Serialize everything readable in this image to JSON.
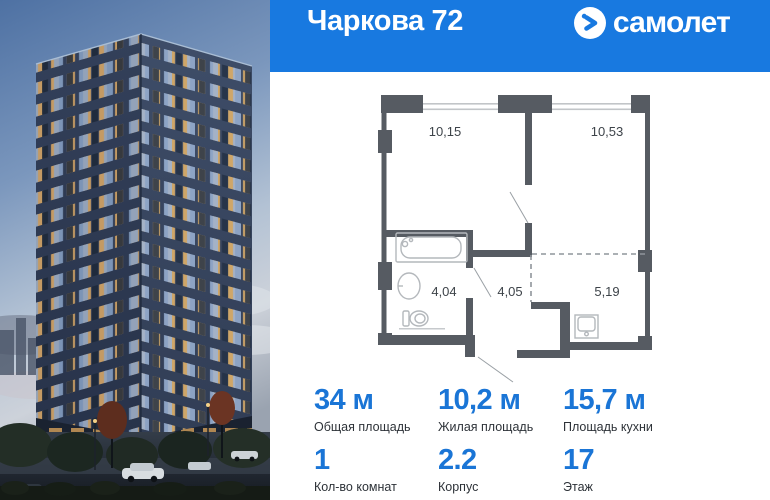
{
  "colors": {
    "header_bg": "#1879e0",
    "accent": "#1a75d6",
    "plan_wall": "#565b62"
  },
  "header": {
    "title": "Чаркова 72",
    "brand": "самолет",
    "brand_icon": "samolet-arrow-circle"
  },
  "plan": {
    "rooms": {
      "living1": "10,15",
      "living2": "10,53",
      "bathroom": "4,04",
      "hallway": "4,05",
      "kitchen": "5,19"
    }
  },
  "stats": {
    "total_area": {
      "value": "34 м",
      "label": "Общая площадь"
    },
    "living_area": {
      "value": "10,2 м",
      "label": "Жилая площадь"
    },
    "kitchen_area": {
      "value": "15,7 м",
      "label": "Площадь кухни"
    },
    "room_count": {
      "value": "1",
      "label": "Кол-во комнат"
    },
    "building": {
      "value": "2.2",
      "label": "Корпус"
    },
    "floor": {
      "value": "17",
      "label": "Этаж"
    }
  }
}
